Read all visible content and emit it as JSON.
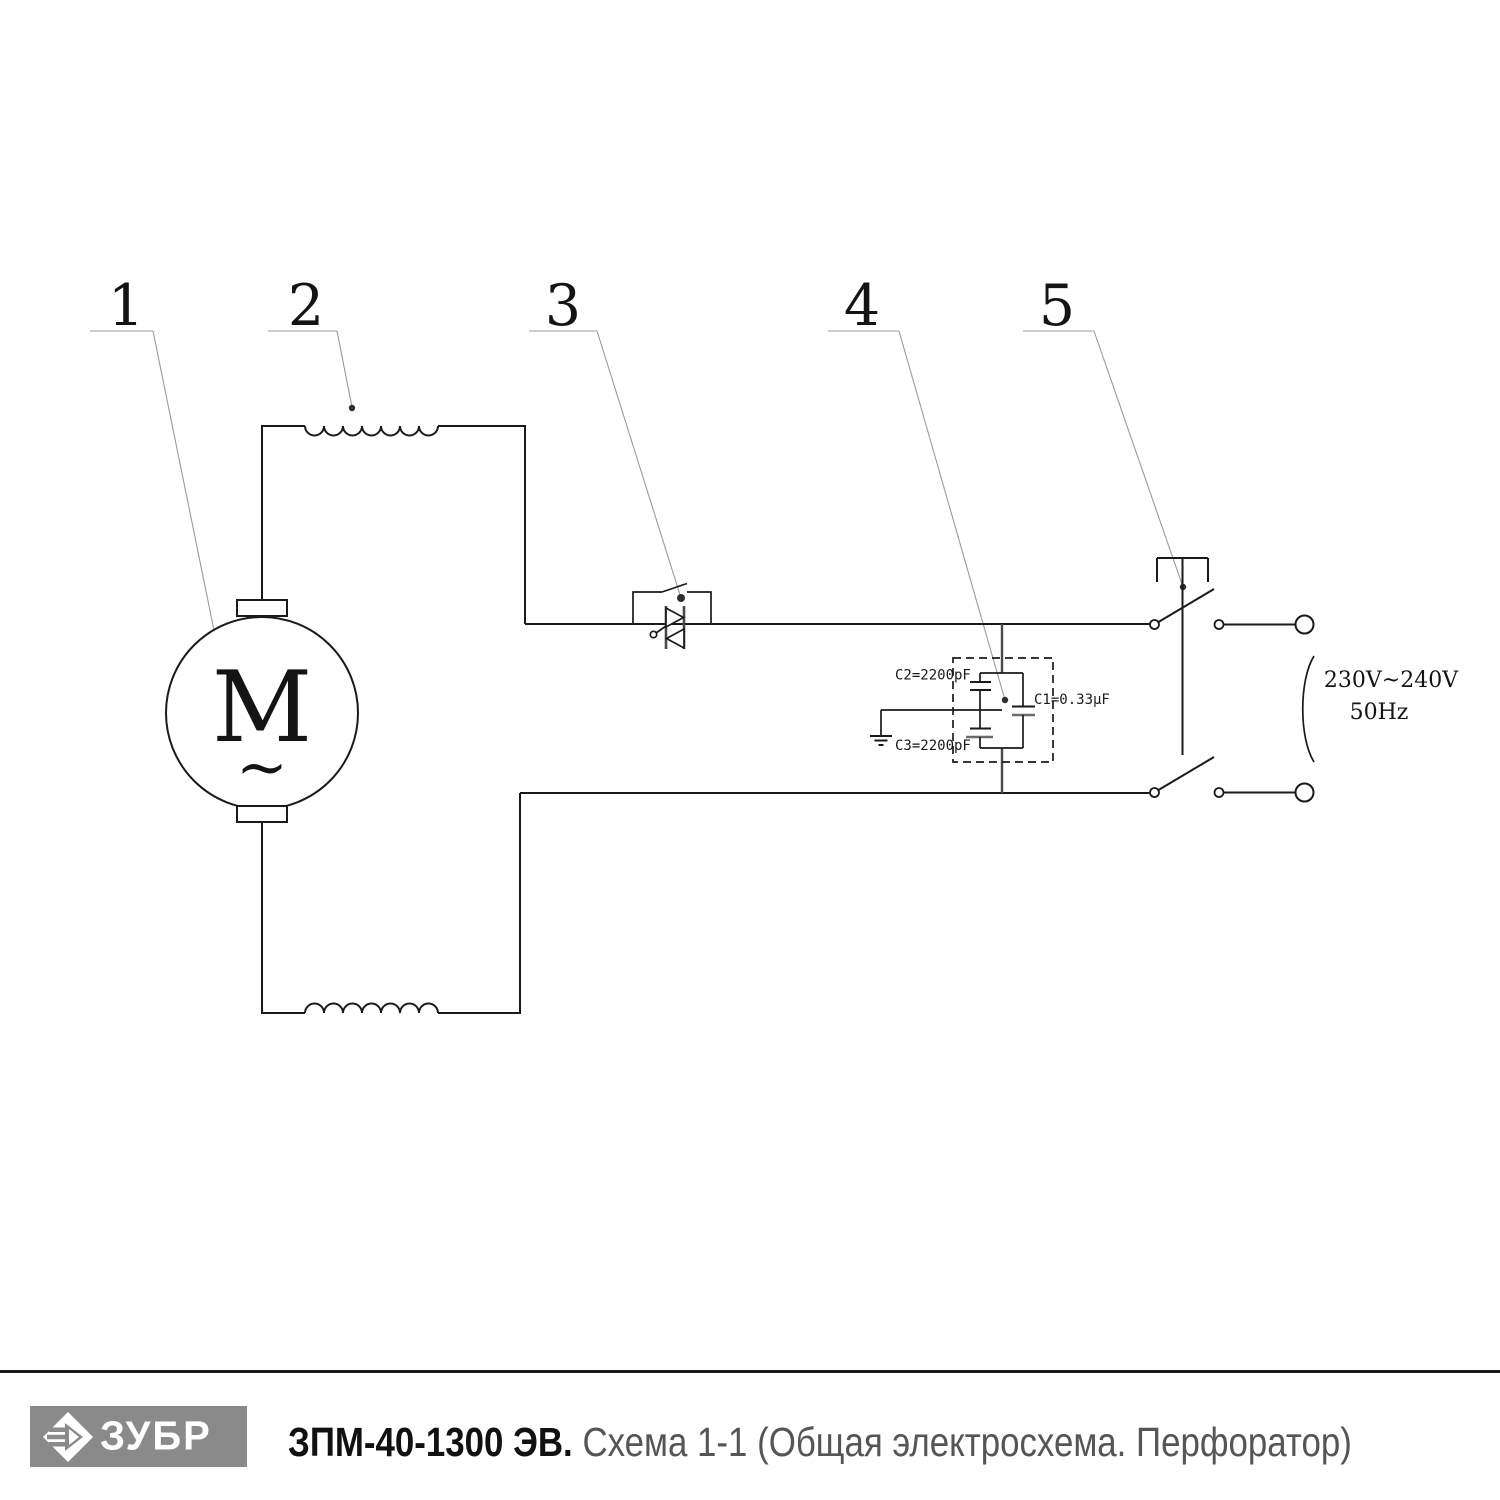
{
  "schematic": {
    "motor_label": "M",
    "motor_ac": "~",
    "callouts": [
      "1",
      "2",
      "3",
      "4",
      "5"
    ],
    "capacitor_labels": {
      "c2": "C2=2200pF",
      "c1": "C1=0.33µF",
      "c3": "C3=2200pF"
    },
    "supply": {
      "voltage": "230V~240V",
      "frequency": "50Hz"
    }
  },
  "footer": {
    "brand": "ЗУБР",
    "model": "ЗПМ-40-1300 ЭВ.",
    "subtitle": "Схема 1-1 (Общая электросхема. Перфоратор)"
  },
  "colors": {
    "line": "#1a1a1a",
    "leader_line": "#9b9b9b",
    "logo_gray": "#8a8a8a",
    "subtitle_gray": "#555555"
  }
}
